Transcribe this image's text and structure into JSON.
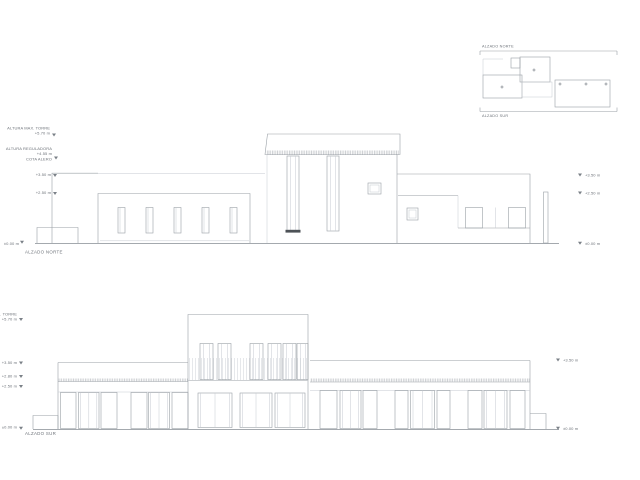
{
  "page": {
    "background": "#ffffff",
    "line_color": "#9aa0a6",
    "text_color": "#6e737a"
  },
  "key_plan": {
    "label_top": "ALZADO NORTE",
    "label_bottom": "ALZADO SUR"
  },
  "north": {
    "label": "ALZADO NORTE",
    "left_levels": [
      {
        "title": "ALTURA MAX. TORRE",
        "value": "+5.70 m"
      },
      {
        "title": "ALTURA REGULADORA",
        "value": "+4.55 m",
        "note": "COTA ALERO"
      },
      {
        "value": "+3.50 m"
      },
      {
        "value": "+2.50 m"
      },
      {
        "value": "±0.00 m"
      }
    ],
    "right_levels": [
      {
        "value": "+3.50 m"
      },
      {
        "value": "+2.50 m"
      },
      {
        "value": "±0.00 m"
      }
    ]
  },
  "south": {
    "label": "ALZADO SUR",
    "left_levels": [
      {
        "title": "ALTURA MAX. TORRE",
        "value": "+5.70 m"
      },
      {
        "value": "+3.50 m"
      },
      {
        "value": "+2.80 m"
      },
      {
        "value": "+2.50 m"
      },
      {
        "value": "±0.00 m"
      }
    ],
    "right_levels": [
      {
        "value": "+3.50 m"
      },
      {
        "value": "±0.00 m"
      }
    ]
  }
}
